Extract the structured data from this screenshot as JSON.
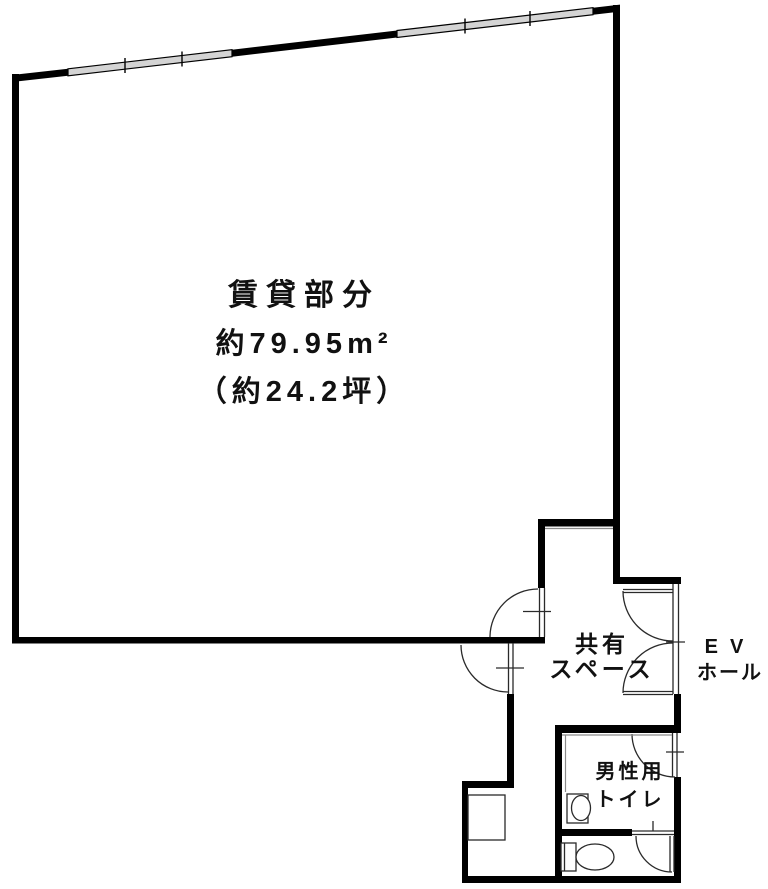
{
  "rooms": {
    "rental": {
      "line1": "賃貸部分",
      "line2": "約79.95m²",
      "line3": "（約24.2坪）"
    },
    "common": {
      "line1": "共有",
      "line2": "スペース"
    },
    "ev": {
      "line1": "EV",
      "line2": "ホール"
    },
    "mens": {
      "line1": "男性用",
      "line2": "トイレ"
    }
  },
  "colors": {
    "wall": "#000000",
    "window_fill": "#d4d4d4",
    "thin_line": "#2a2a2a",
    "background": "#ffffff"
  }
}
